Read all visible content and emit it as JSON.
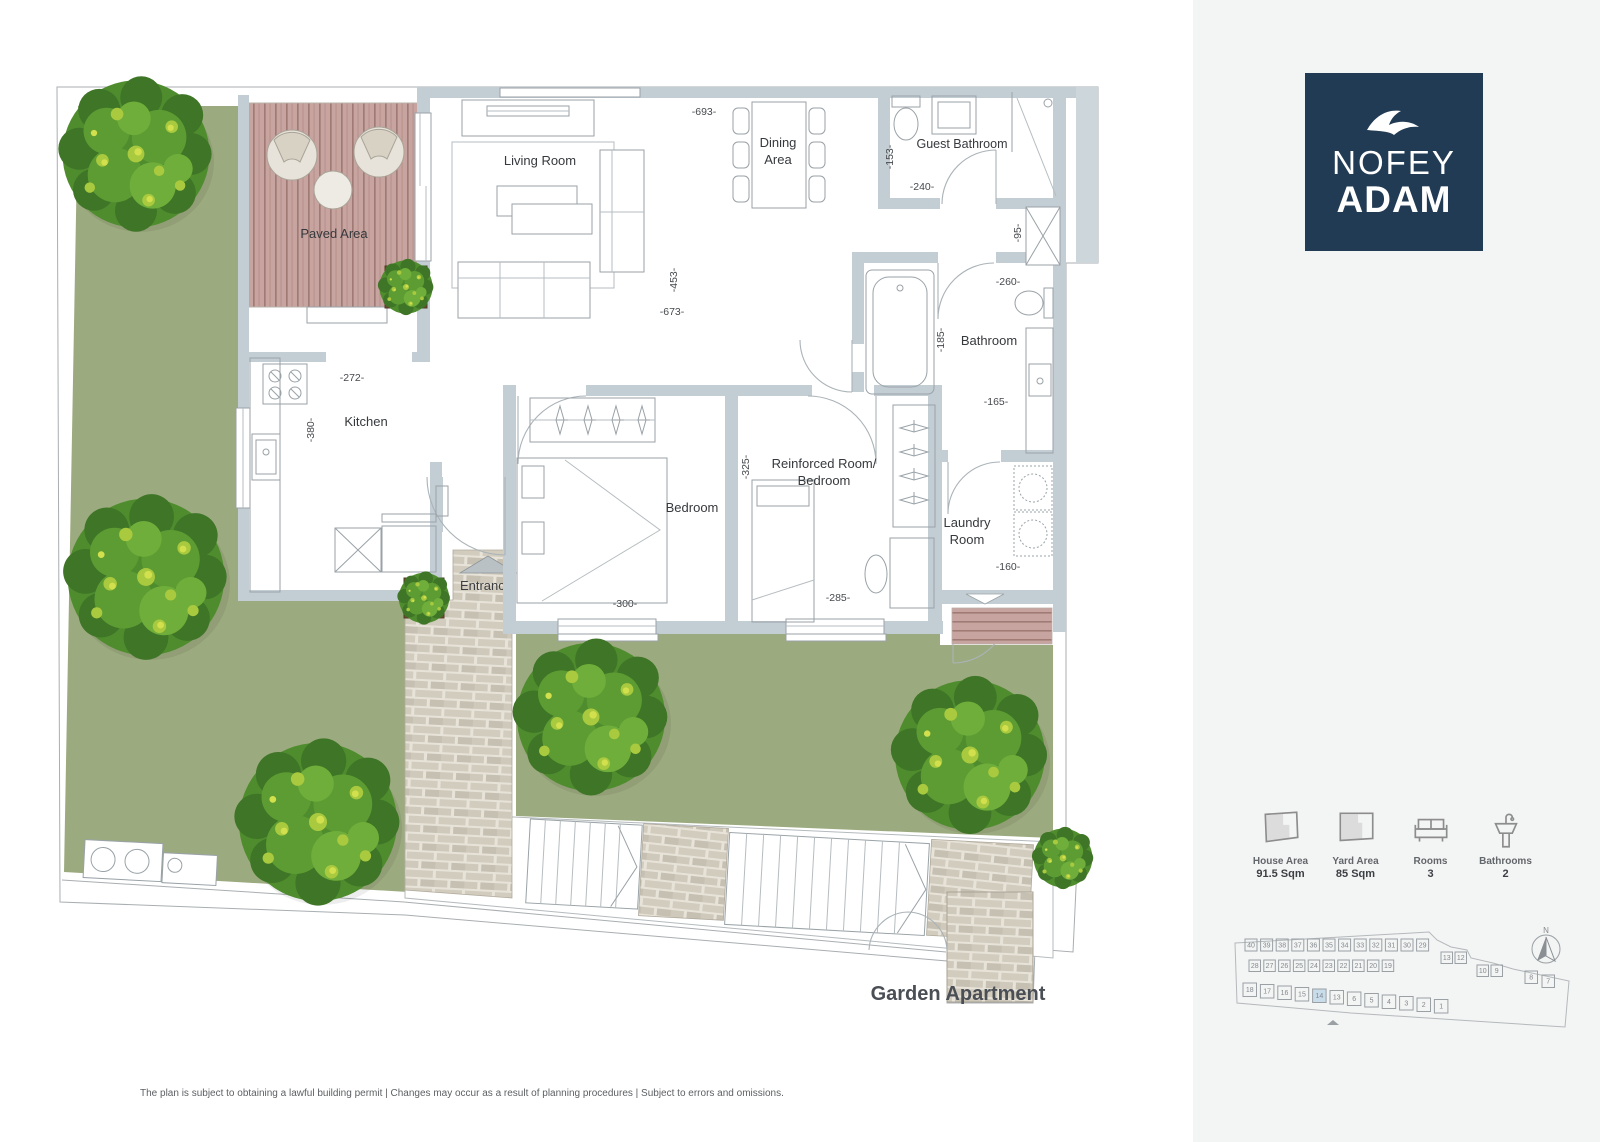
{
  "brand": {
    "name_line1": "NOFEY",
    "name_line2": "ADAM",
    "logo_color": "#223b54",
    "icon": "seagull-icon"
  },
  "plan": {
    "title": "Garden Apartment",
    "labels": {
      "living_room": "Living Room",
      "dining_line1": "Dining",
      "dining_line2": "Area",
      "guest_bathroom": "Guest Bathroom",
      "paved_area": "Paved Area",
      "kitchen": "Kitchen",
      "bedroom": "Bedroom",
      "reinforced_line1": "Reinforced Room/",
      "reinforced_line2": "Bedroom",
      "bathroom": "Bathroom",
      "laundry_line1": "Laundry",
      "laundry_line2": "Room",
      "entrance": "Entrance"
    },
    "dimensions": {
      "living_top": "-693-",
      "living_height": "-453-",
      "living_bottom": "-673-",
      "guest_bath_side": "-153-",
      "guest_bath_width": "-240-",
      "shaft": "-95-",
      "bathroom_top": "-260-",
      "bathroom_side": "-185-",
      "bathroom_inner": "-165-",
      "kitchen_width": "-272-",
      "kitchen_height": "-380-",
      "reinforced_side": "-325-",
      "reinforced_width": "-285-",
      "bedroom_width": "-300-",
      "laundry_width": "-160-"
    }
  },
  "stats": {
    "items": [
      {
        "icon": "house-area-icon",
        "label": "House Area",
        "value": "91.5 Sqm"
      },
      {
        "icon": "yard-area-icon",
        "label": "Yard Area",
        "value": "85 Sqm"
      },
      {
        "icon": "rooms-icon",
        "label": "Rooms",
        "value": "3"
      },
      {
        "icon": "bathrooms-icon",
        "label": "Bathrooms",
        "value": "2"
      }
    ]
  },
  "site_map": {
    "north_label": "N",
    "highlighted_lot": "14",
    "rows": [
      [
        "40",
        "39",
        "38",
        "37",
        "36",
        "35",
        "34",
        "33",
        "32",
        "31",
        "30",
        "29"
      ],
      [
        "28",
        "27",
        "26",
        "25",
        "24",
        "23",
        "22",
        "21",
        "20",
        "19",
        "13",
        "12",
        "10",
        "9"
      ],
      [
        "18",
        "17",
        "16",
        "15",
        "14",
        "13",
        "6",
        "5",
        "4",
        "3",
        "2",
        "1"
      ],
      [
        "8",
        "7"
      ]
    ]
  },
  "footer": {
    "disclaimer": "The plan is subject to obtaining a lawful building permit | Changes may occur as a result of planning procedures | Subject to errors and omissions."
  },
  "colors": {
    "garden": "#9cab7f",
    "wall": "#c3ced4",
    "deck_wood": "#c7a49f",
    "brick_base": "#e8e3d8",
    "navy": "#223b54",
    "sidebar_bg": "#f3f4f4",
    "highlight_lot": "#c8dcea"
  }
}
